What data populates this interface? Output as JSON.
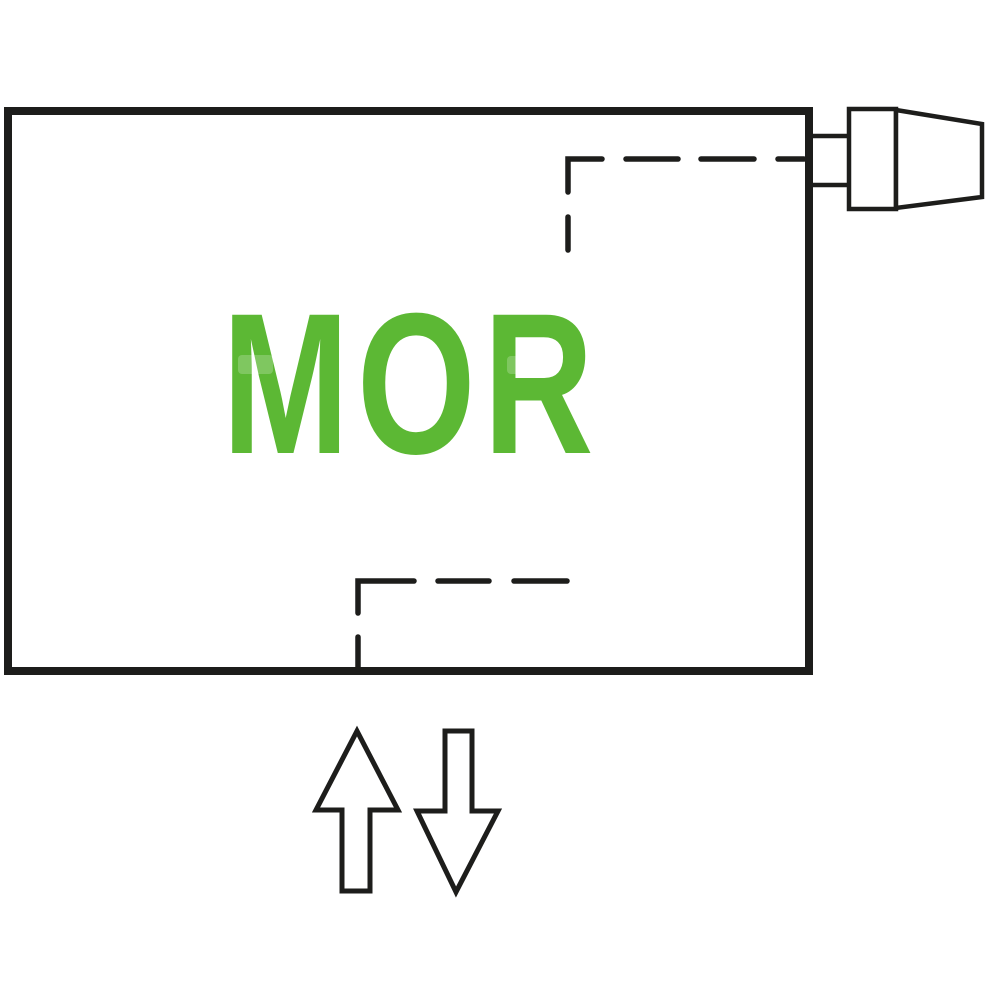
{
  "diagram": {
    "title": "radiator-panel-connection-diagram",
    "panel_label": "MOR",
    "colors": {
      "line": "#1d1d1b",
      "accent_green": "#5cb834",
      "background": "#ffffff"
    },
    "elements": {
      "panel": "radiator-panel-outline",
      "valve": "thermostatic-valve-top-right",
      "top_connection": "dashed-connection-top-right",
      "bottom_connection": "dashed-connection-bottom-center",
      "flow_arrows": [
        "flow-arrow-up",
        "flow-arrow-down"
      ]
    }
  }
}
